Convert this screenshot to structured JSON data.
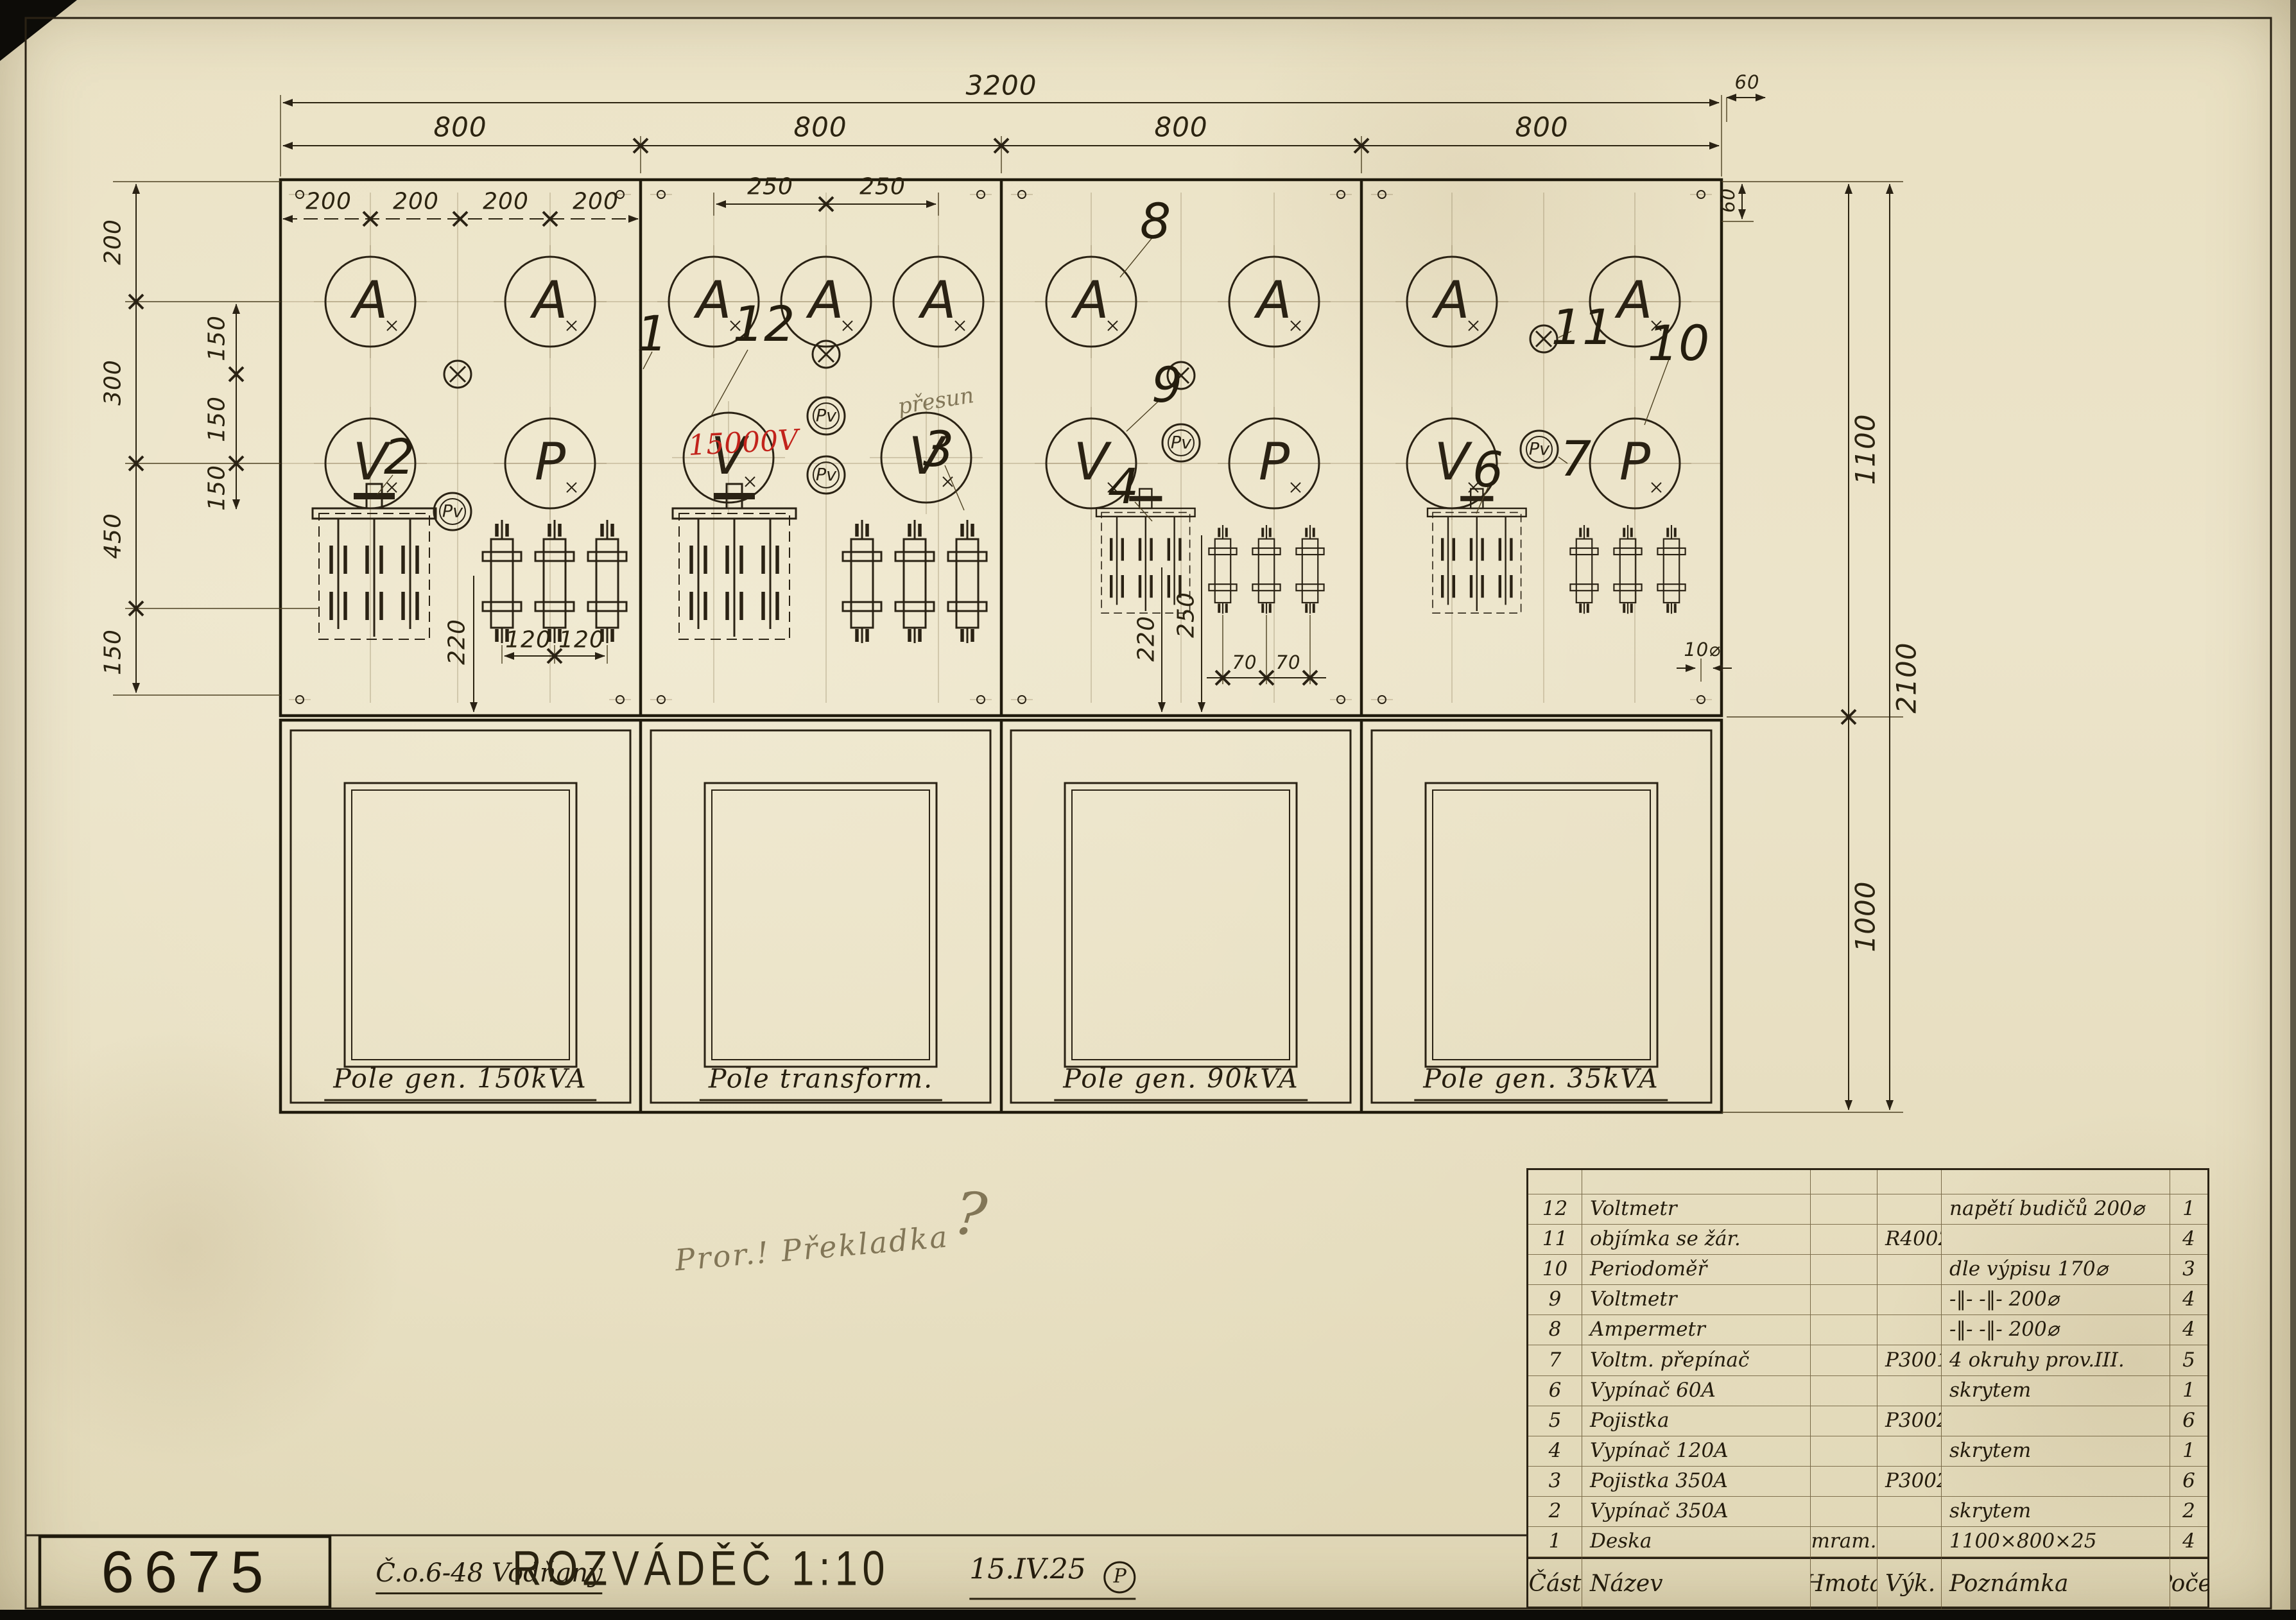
{
  "title_block": {
    "drawing_number": "6675",
    "order": "Č.o.6-48 Vodňany",
    "title": "ROZVÁDĚČ 1:10",
    "date": "15.IV.25",
    "stamp": "P"
  },
  "panels": {
    "p1": "Pole gen. 150kVA",
    "p2": "Pole transform.",
    "p3": "Pole gen. 90kVA",
    "p4": "Pole gen. 35kVA"
  },
  "symbols": {
    "A": "A",
    "V": "V",
    "P": "P",
    "Pv": "Pv"
  },
  "dims": {
    "total": "3200",
    "bay": "800",
    "d200": "200",
    "d250": "250",
    "d300": "300",
    "d450": "450",
    "d150": "150",
    "d220": "220",
    "d120": "120",
    "d70": "70",
    "d60": "60",
    "d1100": "1100",
    "d2100": "2100",
    "d1000": "1000",
    "hole": "10⌀"
  },
  "callouts": {
    "c1": "1",
    "c2": "2",
    "c3": "3",
    "c4": "4",
    "c6": "6",
    "c7": "7",
    "c8": "8",
    "c9": "9",
    "c10": "10",
    "c11": "11",
    "c12": "12"
  },
  "notes": {
    "red_voltage": "15000V",
    "pencil_a": "přesun",
    "pencil_b": "Pror.! Překladka",
    "pencil_q": "?"
  },
  "parts_table": {
    "headers": {
      "num": "Část",
      "name": "Název",
      "material": "Hmota",
      "dwg": "Výk.",
      "note": "Poznámka",
      "qty": "Počet"
    },
    "rows": [
      {
        "num": "12",
        "name": "Voltmetr",
        "material": "",
        "dwg": "",
        "note": "napětí budičů 200⌀",
        "qty": "1"
      },
      {
        "num": "11",
        "name": "objímka se žár.",
        "material": "",
        "dwg": "R40023",
        "note": "",
        "qty": "4"
      },
      {
        "num": "10",
        "name": "Periodoměř",
        "material": "",
        "dwg": "",
        "note": "dle výpisu 170⌀",
        "qty": "3"
      },
      {
        "num": "9",
        "name": "Voltmetr",
        "material": "",
        "dwg": "",
        "note": "-‖-  -‖-  200⌀",
        "qty": "4"
      },
      {
        "num": "8",
        "name": "Ampermetr",
        "material": "",
        "dwg": "",
        "note": "-‖-  -‖-  200⌀",
        "qty": "4"
      },
      {
        "num": "7",
        "name": "Voltm. přepínač",
        "material": "",
        "dwg": "P30012",
        "note": "4 okruhy prov.III.",
        "qty": "5"
      },
      {
        "num": "6",
        "name": "Vypínač 60A",
        "material": "",
        "dwg": "",
        "note": "skrytem",
        "qty": "1"
      },
      {
        "num": "5",
        "name": "Pojistka",
        "material": "",
        "dwg": "P30022",
        "note": "",
        "qty": "6"
      },
      {
        "num": "4",
        "name": "Vypínač 120A",
        "material": "",
        "dwg": "",
        "note": "skrytem",
        "qty": "1"
      },
      {
        "num": "3",
        "name": "Pojistka 350A",
        "material": "",
        "dwg": "P30025",
        "note": "",
        "qty": "6"
      },
      {
        "num": "2",
        "name": "Vypínač 350A",
        "material": "",
        "dwg": "",
        "note": "skrytem",
        "qty": "2"
      },
      {
        "num": "1",
        "name": "Deska",
        "material": "mram.",
        "dwg": "",
        "note": "1100×800×25",
        "qty": "4"
      }
    ]
  }
}
